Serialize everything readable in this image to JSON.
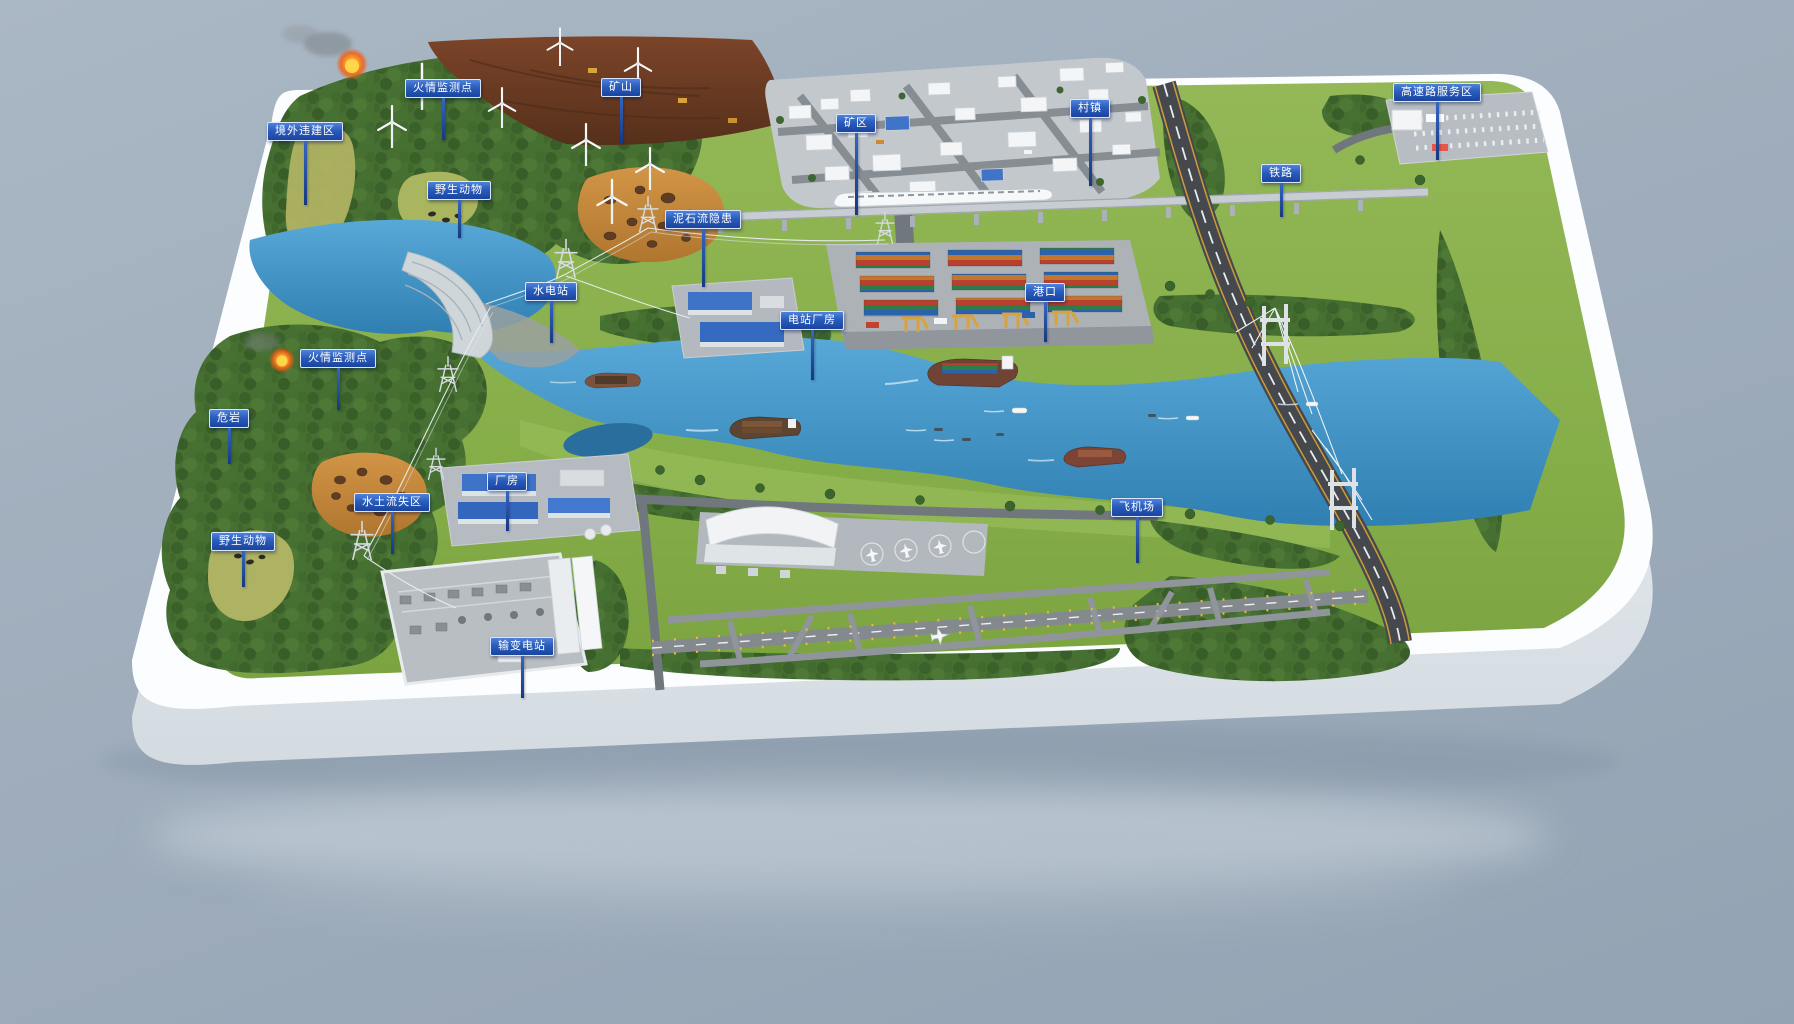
{
  "labels": [
    {
      "text": "境外违建区"
    },
    {
      "text": "火情监测点"
    },
    {
      "text": "矿山"
    },
    {
      "text": "野生动物"
    },
    {
      "text": "泥石流隐患"
    },
    {
      "text": "水电站"
    },
    {
      "text": "矿区"
    },
    {
      "text": "村镇"
    },
    {
      "text": "铁路"
    },
    {
      "text": "高速路服务区"
    },
    {
      "text": "港口"
    },
    {
      "text": "电站厂房"
    },
    {
      "text": "火情监测点"
    },
    {
      "text": "危岩"
    },
    {
      "text": "水土流失区"
    },
    {
      "text": "厂房"
    },
    {
      "text": "野生动物"
    },
    {
      "text": "飞机场"
    },
    {
      "text": "输变电站"
    }
  ],
  "colors": {
    "background": "#9fadbc",
    "platform": "#fcfdfe",
    "land_green": "#8ab14e",
    "forest_green": "#466f31",
    "water_blue": "#3f93c6",
    "mine_brown": "#6f3d26",
    "erosion_orange": "#c4873c",
    "marker_blue": "#2a5cbb",
    "road_gray": "#45494e",
    "runway_gray": "#84898e",
    "crane_yellow": "#d9a33b",
    "fire_orange": "#ff9b2e"
  },
  "icons": {
    "wind_turbine": "three-blade-rotor",
    "transmission_tower": "lattice-pylon",
    "fire": "flame-with-smoke",
    "cargo_ship": "container-vessel",
    "bullet_train": "white-high-speed-train",
    "airplane": "small-jet",
    "port_crane": "yellow-gantry-crane"
  }
}
